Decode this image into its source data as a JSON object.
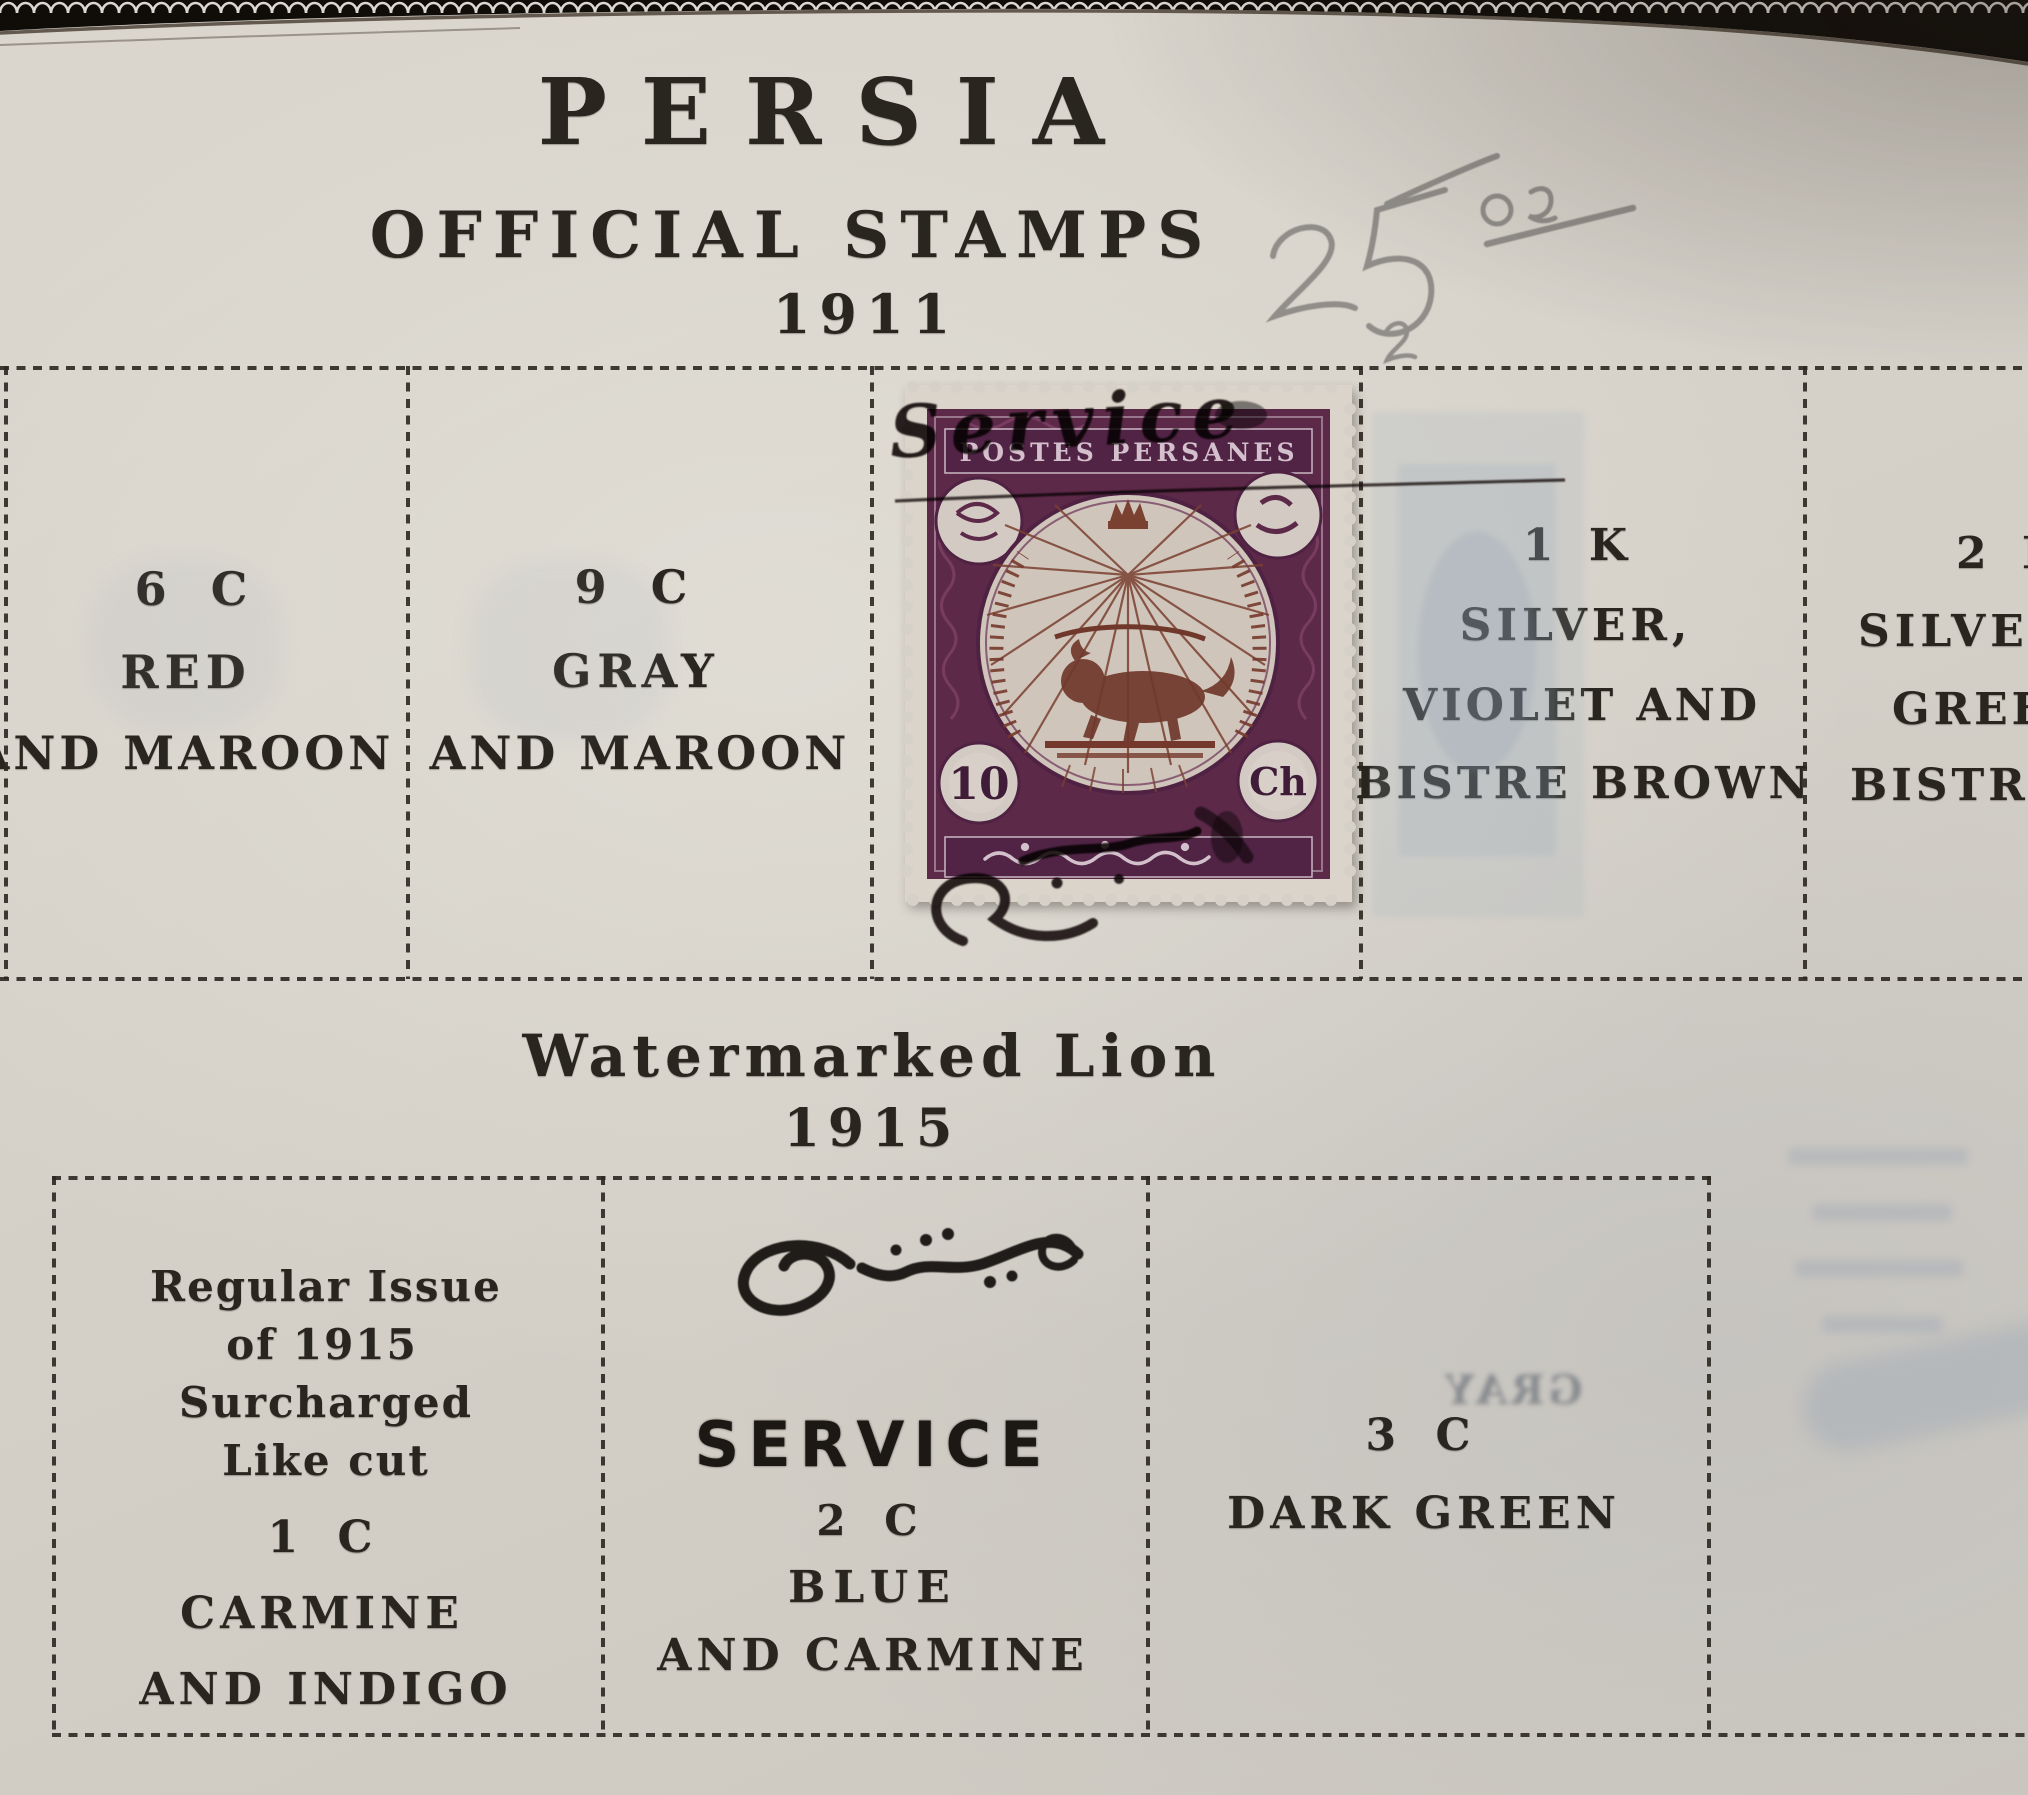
{
  "page": {
    "title": "PERSIA",
    "subtitle": "OFFICIAL STAMPS",
    "year": "1911",
    "pencil_note": "25 00"
  },
  "section1915": {
    "heading": "Watermarked Lion",
    "year": "1915"
  },
  "row1911": {
    "cells": [
      {
        "lines": [
          "6 C",
          "RED",
          "AND MAROON"
        ]
      },
      {
        "lines": [
          "9 C",
          "GRAY",
          "AND MAROON"
        ]
      },
      {
        "lines": []
      },
      {
        "lines": [
          "1 K",
          "SILVER,",
          "VIOLET AND",
          "BISTRE BROWN"
        ]
      },
      {
        "lines": [
          "2 K",
          "SILVER,",
          "GREEN",
          "BISTRE"
        ]
      }
    ]
  },
  "stamp": {
    "top_inscription": "POSTES PERSANES",
    "overprint": "Service",
    "value_left": "10",
    "value_right": "Ch"
  },
  "row1915": {
    "cells": [
      {
        "lines": [
          "Regular Issue",
          "of 1915",
          "Surcharged",
          "Like cut",
          "1 C",
          "CARMINE",
          "AND INDIGO"
        ]
      },
      {
        "overprint": "SERVICE",
        "lines": [
          "2 C",
          "BLUE",
          "AND CARMINE"
        ]
      },
      {
        "lines": [
          "3 C",
          "DARK GREEN"
        ]
      }
    ]
  },
  "ghosts": {
    "mirrored_text": "GRAY"
  },
  "colors": {
    "page": "#d5d1c9",
    "ink": "#29251f",
    "stamp_frame": "#5d2949",
    "stamp_center_brown": "#7a4030",
    "overprint_ink": "#17130f",
    "pencil": "#8b8884"
  }
}
